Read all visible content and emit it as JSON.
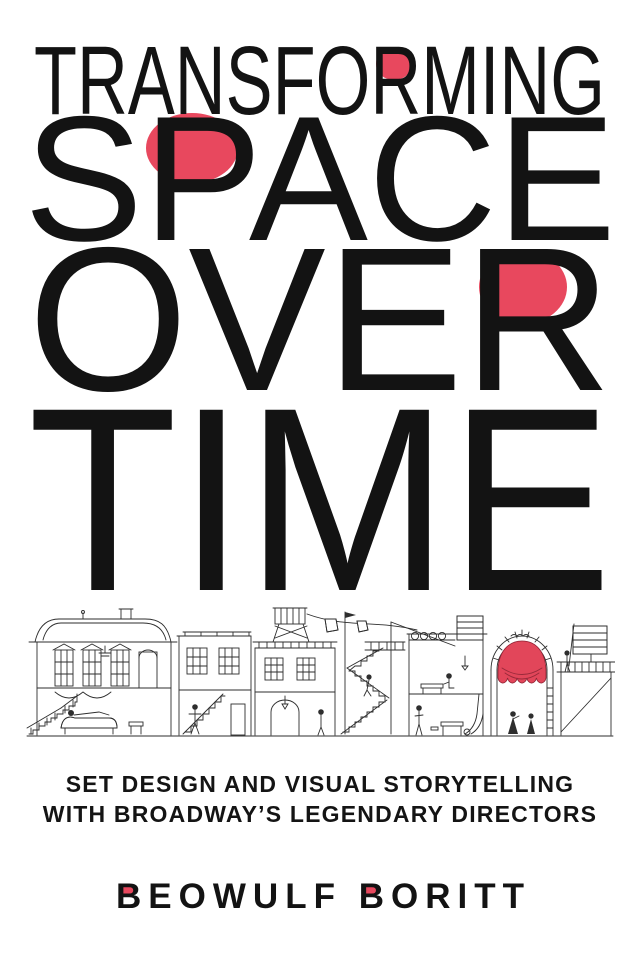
{
  "cover": {
    "background_color": "#ffffff",
    "ink_color": "#131313",
    "accent_red": "#e8485e",
    "title": {
      "line1": "TRANSFORMING",
      "line2": "SPACE",
      "line3": "OVER",
      "line4": "TIME",
      "red_letter_accents": [
        "bowl of second R in TRANSFORMING",
        "bowl of P in SPACE",
        "bowl of R in OVER"
      ]
    },
    "subtitle": {
      "line1": "SET DESIGN AND VISUAL STORYTELLING",
      "line2": "WITH BROADWAY’S LEGENDARY DIRECTORS"
    },
    "author": {
      "name": "BEOWULF BORITT",
      "red_letter_accents": [
        "counter of B in BEOWULF",
        "counter of B in BORITT"
      ]
    },
    "illustration": {
      "description": "Continuous pen-and-ink cross-section of Broadway stage sets",
      "curtain_color": "#e2465a",
      "elements": [
        "mansard-roof parlor with chaise and chandelier",
        "curved exterior staircase",
        "row house with interior stair",
        "rooftop water tower",
        "clotheslines with hanging sheets",
        "switchback scaffold stairs with pennant pole",
        "workshop frame with barrels and desk",
        "proscenium arch with red swag curtain",
        "ladder on arch pillar",
        "costumed figures",
        "stage platform with railing and brace"
      ]
    }
  }
}
